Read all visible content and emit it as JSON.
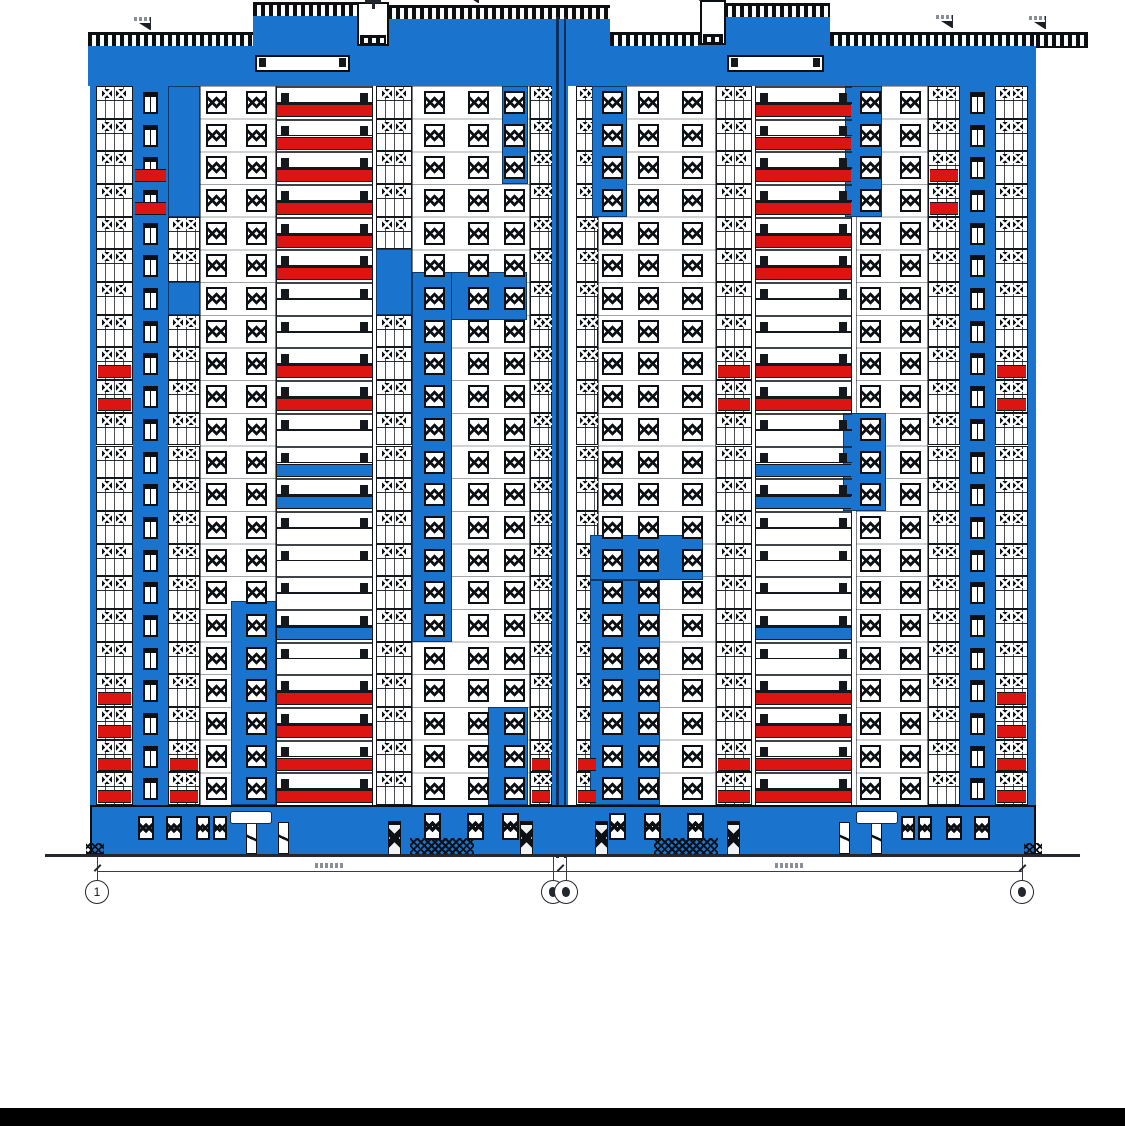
{
  "title": "building-facade-elevation",
  "page": {
    "w": 1125,
    "h": 1126,
    "bg": "#ffffff"
  },
  "colors": {
    "blue": "#1a74cd",
    "red": "#dd1512",
    "ink": "#0d1115",
    "grid": "#24282e",
    "smear": "#8a8f96"
  },
  "drawing": {
    "mirrorAxis": 1128,
    "roof": {
      "segments": [
        {
          "x": 88,
          "w": 165,
          "cy": 32,
          "copingOnly": false
        },
        {
          "x": 253,
          "w": 107,
          "cy": 2,
          "copingOnly": false
        },
        {
          "x": 388,
          "w": 222,
          "cy": 5,
          "copingOnly": false
        },
        {
          "x": 610,
          "w": 92,
          "cy": 32,
          "copingOnly": false
        },
        {
          "x": 724,
          "w": 106,
          "cy": 3,
          "copingOnly": false
        },
        {
          "x": 830,
          "w": 206,
          "cy": 32,
          "copingOnly": false
        },
        {
          "x": 1036,
          "w": 52,
          "cy": 32,
          "copingOnly": true
        }
      ],
      "machineRooms": [
        {
          "x": 357,
          "y": 2,
          "w": 32,
          "h": 44,
          "antenna": true
        },
        {
          "x": 700,
          "y": 0,
          "w": 26,
          "h": 45,
          "antenna": false
        }
      ],
      "machineRoomFills": [
        [
          353,
          46,
          40,
          40
        ],
        [
          698,
          45,
          30,
          41
        ]
      ],
      "slots": [
        [
          255,
          55,
          95,
          17
        ],
        [
          727,
          55,
          97,
          17
        ]
      ],
      "flags": [
        [
          150,
          30
        ],
        [
          478,
          3
        ],
        [
          700,
          1
        ],
        [
          952,
          28
        ],
        [
          1045,
          29
        ]
      ]
    },
    "facade": {
      "left": 90,
      "right": 1036,
      "top": 86,
      "bottom": 805,
      "floors": 22,
      "edgeStrips": [
        [
          90,
          86,
          6,
          719
        ],
        [
          1028,
          86,
          8,
          719
        ]
      ],
      "strips": [
        {
          "t": "glazed",
          "x": 96,
          "w": 37
        },
        {
          "t": "pier",
          "x": 133,
          "w": 35
        },
        {
          "t": "glazed",
          "x": 168,
          "w": 32
        },
        {
          "t": "wall",
          "x": 200,
          "w": 76,
          "wins": [
            206,
            246
          ]
        },
        {
          "t": "balcony",
          "x": 276,
          "w": 97,
          "side": "left"
        },
        {
          "t": "glazed",
          "x": 376,
          "w": 36
        },
        {
          "t": "wall",
          "x": 412,
          "w": 118,
          "wins": [
            424,
            468,
            504
          ]
        },
        {
          "t": "glazed",
          "x": 530,
          "w": 22
        },
        {
          "t": "joint",
          "x": 552,
          "w": 16
        },
        {
          "t": "glazed",
          "x": 576,
          "w": 22
        },
        {
          "t": "wall",
          "x": 598,
          "w": 118,
          "wins": [
            602,
            638,
            682
          ]
        },
        {
          "t": "glazed",
          "x": 716,
          "w": 36
        },
        {
          "t": "balcony",
          "x": 755,
          "w": 97,
          "side": "right"
        },
        {
          "t": "wall",
          "x": 856,
          "w": 72,
          "wins": [
            860,
            900
          ]
        },
        {
          "t": "glazed",
          "x": 928,
          "w": 32
        },
        {
          "t": "pier",
          "x": 960,
          "w": 35
        },
        {
          "t": "glazed",
          "x": 995,
          "w": 33
        }
      ],
      "balconyColors": {
        "left": [
          "red",
          "red",
          "red",
          "red",
          "red",
          "red",
          "white",
          "white",
          "red",
          "red",
          "white",
          "blue",
          "blue",
          "white",
          "white",
          "white",
          "blue",
          "white",
          "red",
          "red",
          "red",
          "red"
        ],
        "right": [
          "red",
          "red",
          "red",
          "red",
          "red",
          "red",
          "white",
          "white",
          "red",
          "red",
          "white",
          "blue",
          "blue",
          "white",
          "white",
          "white",
          "blue",
          "white",
          "red",
          "red",
          "red",
          "red"
        ]
      },
      "patches": [
        [
          168,
          86,
          32,
          131
        ],
        [
          168,
          282,
          32,
          33
        ],
        [
          502,
          86,
          26,
          98
        ],
        [
          592,
          86,
          35,
          131
        ],
        [
          845,
          86,
          37,
          131
        ],
        [
          376,
          249,
          36,
          66
        ],
        [
          412,
          272,
          115,
          48
        ],
        [
          412,
          272,
          40,
          370
        ],
        [
          488,
          707,
          40,
          98
        ],
        [
          231,
          601,
          45,
          204
        ],
        [
          590,
          535,
          113,
          45
        ],
        [
          590,
          580,
          70,
          225
        ],
        [
          843,
          413,
          43,
          98
        ]
      ],
      "accents": [
        {
          "x": 96,
          "w": 37,
          "floors": [
            8,
            9,
            18,
            19,
            20,
            21
          ]
        },
        {
          "x": 133,
          "w": 35,
          "floors": [
            2,
            3
          ]
        },
        {
          "x": 168,
          "w": 32,
          "floors": [
            20,
            21
          ]
        },
        {
          "x": 530,
          "w": 22,
          "floors": [
            20,
            21
          ]
        },
        {
          "x": 576,
          "w": 22,
          "floors": [
            20,
            21
          ]
        },
        {
          "x": 716,
          "w": 36,
          "floors": [
            8,
            9,
            20,
            21
          ]
        },
        {
          "x": 928,
          "w": 32,
          "floors": [
            2,
            3
          ]
        },
        {
          "x": 995,
          "w": 33,
          "floors": [
            8,
            9,
            18,
            19,
            20,
            21
          ]
        }
      ],
      "jointLines": [
        [
          556,
          17,
          2.5,
          841
        ],
        [
          563.5,
          17,
          2.5,
          841
        ]
      ]
    },
    "ground": {
      "band": [
        90,
        805,
        946,
        52
      ],
      "windows": [
        [
          138,
          816,
          16,
          24
        ],
        [
          166,
          816,
          16,
          24
        ],
        [
          196,
          816,
          14,
          24
        ],
        [
          213,
          816,
          14,
          24
        ],
        [
          424,
          813,
          17,
          27
        ],
        [
          467,
          813,
          17,
          27
        ],
        [
          502,
          813,
          17,
          27
        ]
      ],
      "doorsWhite": [
        [
          246,
          822,
          11,
          32
        ],
        [
          278,
          822,
          11,
          32
        ]
      ],
      "doorsDark": [
        [
          388,
          821,
          13,
          34
        ],
        [
          520,
          821,
          13,
          34
        ]
      ],
      "sign": [
        230,
        811,
        42,
        13
      ],
      "hatch": [
        410,
        838,
        64,
        18
      ],
      "porch": [
        86,
        843,
        18,
        12
      ]
    },
    "site": {
      "groundLine": [
        45,
        854,
        1035,
        2.5
      ],
      "extLines": [
        97,
        553,
        566,
        1022
      ],
      "dimY": 871,
      "dimSpans": [
        [
          97,
          560
        ],
        [
          560,
          1022
        ]
      ],
      "dimTextSmears": [
        [
          315,
          863
        ],
        [
          775,
          863
        ]
      ],
      "footerBar": [
        0,
        1108,
        1125,
        18
      ]
    },
    "axes": [
      {
        "cx": 97,
        "label": "1",
        "double": false
      },
      {
        "cx": 553,
        "label": "",
        "double": true,
        "cx2": 566
      },
      {
        "cx": 1022,
        "label": "",
        "double": false
      }
    ]
  }
}
